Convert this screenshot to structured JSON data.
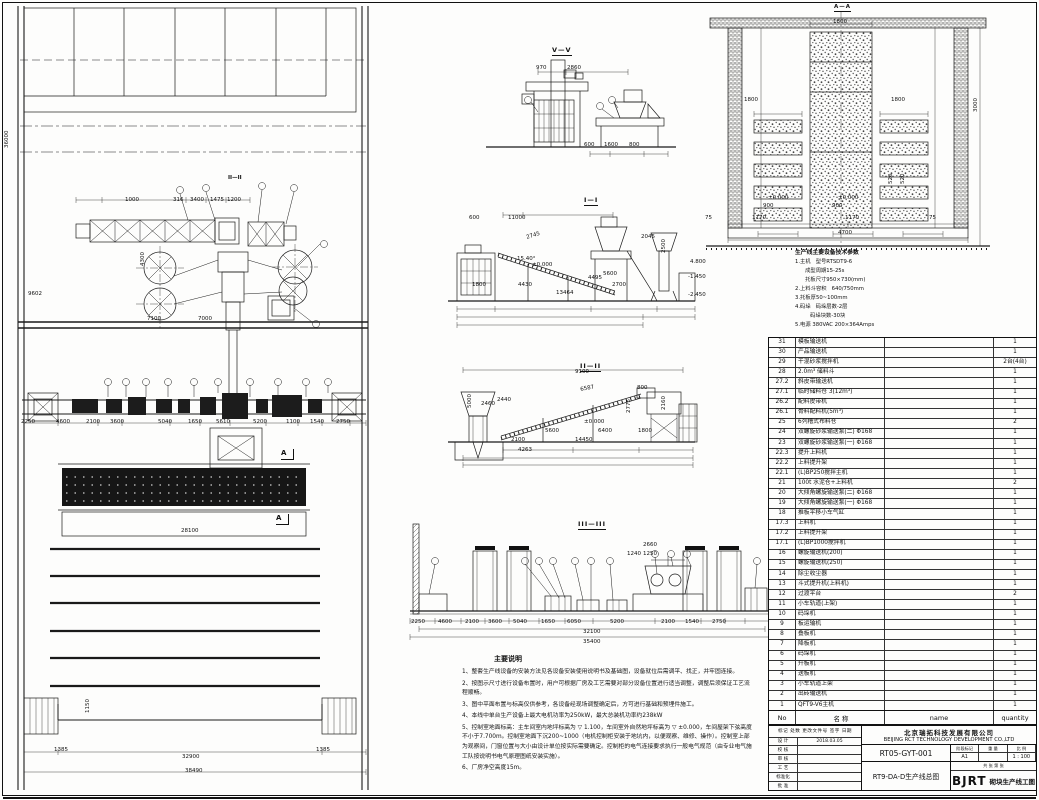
{
  "sections": {
    "s5": "V—V",
    "s1": "I—I",
    "s2": "II—II",
    "s3": "III—III",
    "plan_mark": "II—II",
    "kiln": "A—A",
    "a1": "A",
    "a2": "A"
  },
  "notes": {
    "title": "主要说明",
    "items": [
      {
        "text": "1、整套生产线设备的安装方法见各设备安装使用说明书及基础图，设备就位后需调平、找正，并牢固连接。"
      },
      {
        "text": "2、按图示尺寸进行设备布置时，用户可根据厂房及工艺需要对部分设备位置进行适当调整，调整后须保证工艺流程顺畅。"
      },
      {
        "text": "3、图中平面布置与标高仅供参考，各设备经现场调整确定后，方可进行基础和预埋件施工。"
      },
      {
        "text": "4、本线中单台生产设备上最大电机功率为250kW，最大总装机功率约238kW"
      },
      {
        "text": "5、控制室地面标高：主车间室内地坪标高为 ▽ 1.100，车间室外自然地坪标高为 ▽ ±0.000，车间屋架下弦高度不小于7.700m。控制室地面下沉200~1000（电机控制柜安装于地坑内，以便观察、维修、操作）。控制室上部为观察间，门窗位置与大小由设计单位按实际需要确定。控制柜的电气连接要求执行一般电气规范（由专业电气施工队按说明书电气原理图纸安装实施）。"
      },
      {
        "text": "6、厂房净空高度15m。"
      }
    ]
  },
  "tech_params": {
    "title": "生产线主要设备技术参数",
    "lines": [
      {
        "text": "1.主机   型号RTSDT9-6"
      },
      {
        "text": "      成型周期15-25s"
      },
      {
        "text": "      托板尺寸950×730(mm)"
      },
      {
        "text": "2.上料斗容积   640/750mm"
      },
      {
        "text": "3.托板厚50~100mm"
      },
      {
        "text": "4.码垛   码垛层数-2层"
      },
      {
        "text": "         码垛块数-30块"
      },
      {
        "text": "5.电源 380VAC 200×364Amps"
      }
    ]
  },
  "parts_list": {
    "header": {
      "no": "No",
      "cn": "名        称",
      "en": "name",
      "qty": "quantity"
    },
    "rows": [
      {
        "no": "1",
        "name": "QFT9-V6主机",
        "qty": "1"
      },
      {
        "no": "2",
        "name": "出砖输送机",
        "qty": "1"
      },
      {
        "no": "3",
        "name": "小车轨道上架",
        "qty": "1"
      },
      {
        "no": "4",
        "name": "送板机",
        "qty": "1"
      },
      {
        "no": "5",
        "name": "升板机",
        "qty": "1"
      },
      {
        "no": "6",
        "name": "码垛机",
        "qty": "1"
      },
      {
        "no": "7",
        "name": "降板机",
        "qty": "1"
      },
      {
        "no": "8",
        "name": "叠板机",
        "qty": "1"
      },
      {
        "no": "9",
        "name": "板运输机",
        "qty": "1"
      },
      {
        "no": "10",
        "name": "码垛机",
        "qty": "1"
      },
      {
        "no": "11",
        "name": "小车轨道(上架)",
        "qty": "1"
      },
      {
        "no": "12",
        "name": "过渡平台",
        "qty": "2"
      },
      {
        "no": "13",
        "name": "斗式提升机(上料机)",
        "qty": "1"
      },
      {
        "no": "14",
        "name": "除尘收尘器",
        "qty": "1"
      },
      {
        "no": "15",
        "name": "螺旋输送机(250)",
        "qty": "1"
      },
      {
        "no": "16",
        "name": "螺旋输送机(200)",
        "qty": "1"
      },
      {
        "no": "17.1",
        "name": "(L)BP1000搅拌机",
        "qty": "1"
      },
      {
        "no": "17.2",
        "name": "上料提升架",
        "qty": "1"
      },
      {
        "no": "17.3",
        "name": "上料机",
        "qty": "1"
      },
      {
        "no": "18",
        "name": "推板平移小车气缸",
        "qty": "1"
      },
      {
        "no": "19",
        "name": "大倾角螺旋输送泵(一) Φ168",
        "qty": "1"
      },
      {
        "no": "20",
        "name": "大倾角螺旋输送泵(二) Φ168",
        "qty": "1"
      },
      {
        "no": "21",
        "name": "100t 水泥仓+上料机",
        "qty": "2"
      },
      {
        "no": "22.1",
        "name": "(L)BP250搅拌主机",
        "qty": "1"
      },
      {
        "no": "22.2",
        "name": "上料提升架",
        "qty": "1"
      },
      {
        "no": "22.3",
        "name": "提升上料机",
        "qty": "1"
      },
      {
        "no": "23",
        "name": "双螺旋砂浆输送泵(一) Φ168",
        "qty": "1"
      },
      {
        "no": "24",
        "name": "双螺旋砂浆输送泵(二) Φ168",
        "qty": "1"
      },
      {
        "no": "25",
        "name": "6列槽式布料仓",
        "qty": "2"
      },
      {
        "no": "26.1",
        "name": "骨料配料机(5m³)",
        "qty": "1"
      },
      {
        "no": "26.2",
        "name": "配料皮带机",
        "qty": "1"
      },
      {
        "no": "27.1",
        "name": "临时储料仓 3(12m³)",
        "qty": "1"
      },
      {
        "no": "27.2",
        "name": "斜皮带输送机",
        "qty": "1"
      },
      {
        "no": "28",
        "name": "2.0m³ 储料斗",
        "qty": "1"
      },
      {
        "no": "29",
        "name": "干混砂浆搅拌机",
        "qty": "2台(4台)"
      },
      {
        "no": "30",
        "name": "产品输送机",
        "qty": "1"
      },
      {
        "no": "31",
        "name": "模板输送机",
        "qty": "1"
      }
    ]
  },
  "title_block": {
    "company_cn": "北京瑞拓科技发展有限公司",
    "company_en": "BEIJING RCT TECHNOLOGY DEVELOPMENT CO.,LTD",
    "drawing_no": "RT05-GYT-001",
    "date": "2018.03.05",
    "drawing_title": "RT9-DA-D生产线总图",
    "sheet_size": "A1",
    "scale": "1 : 100",
    "logo": "BJRT",
    "project": "砌块生产线工图",
    "stage_label": "阶段标记",
    "weight_label": "重 量",
    "scale_label": "比 例",
    "sheets": "共  张   第  张",
    "rev_header_line": "标记 处数 更改文件号 签字 日期",
    "rev_rows": [
      {
        "label": "设 计",
        "val": "2018.03.05"
      },
      {
        "label": "校 核",
        "val": ""
      },
      {
        "label": "审 核",
        "val": ""
      },
      {
        "label": "工 艺",
        "val": ""
      },
      {
        "label": "标准化",
        "val": ""
      },
      {
        "label": "批 准",
        "val": ""
      }
    ]
  },
  "dim_labels": [
    {
      "t": "1800",
      "x": 833,
      "y": 20
    },
    {
      "t": "1800",
      "x": 744,
      "y": 98
    },
    {
      "t": "1800",
      "x": 891,
      "y": 98
    },
    {
      "t": "±0.000",
      "x": 768,
      "y": 196
    },
    {
      "t": "±0.000",
      "x": 838,
      "y": 196
    },
    {
      "t": "900",
      "x": 763,
      "y": 204
    },
    {
      "t": "900",
      "x": 832,
      "y": 204
    },
    {
      "t": "520",
      "x": 889,
      "y": 184,
      "r": -90
    },
    {
      "t": "520",
      "x": 901,
      "y": 184,
      "r": -90
    },
    {
      "t": "75",
      "x": 705,
      "y": 216
    },
    {
      "t": "1170",
      "x": 752,
      "y": 216
    },
    {
      "t": "1170",
      "x": 845,
      "y": 216
    },
    {
      "t": "75",
      "x": 929,
      "y": 216
    },
    {
      "t": "4700",
      "x": 838,
      "y": 231
    },
    {
      "t": "3000",
      "x": 974,
      "y": 112,
      "r": -90
    },
    {
      "t": "970",
      "x": 536,
      "y": 66
    },
    {
      "t": "2860",
      "x": 567,
      "y": 66
    },
    {
      "t": "600",
      "x": 584,
      "y": 143
    },
    {
      "t": "1600",
      "x": 604,
      "y": 143
    },
    {
      "t": "800",
      "x": 629,
      "y": 143
    },
    {
      "t": "600",
      "x": 469,
      "y": 216
    },
    {
      "t": "11000",
      "x": 508,
      "y": 216
    },
    {
      "t": "2745",
      "x": 526,
      "y": 236,
      "r": -17
    },
    {
      "t": "15.40°",
      "x": 517,
      "y": 257
    },
    {
      "t": "±0.000",
      "x": 532,
      "y": 263
    },
    {
      "t": "1800",
      "x": 472,
      "y": 283
    },
    {
      "t": "4430",
      "x": 518,
      "y": 283
    },
    {
      "t": "4495",
      "x": 588,
      "y": 276
    },
    {
      "t": "5600",
      "x": 603,
      "y": 272
    },
    {
      "t": "2700",
      "x": 612,
      "y": 283
    },
    {
      "t": "13464",
      "x": 556,
      "y": 291
    },
    {
      "t": "2045",
      "x": 641,
      "y": 235
    },
    {
      "t": "2500",
      "x": 662,
      "y": 253,
      "r": -90
    },
    {
      "t": "4.800",
      "x": 690,
      "y": 260
    },
    {
      "t": "-1.450",
      "x": 688,
      "y": 275
    },
    {
      "t": "-2.450",
      "x": 688,
      "y": 293
    },
    {
      "t": "9100",
      "x": 575,
      "y": 370
    },
    {
      "t": "6587",
      "x": 580,
      "y": 388,
      "r": -11
    },
    {
      "t": "800",
      "x": 637,
      "y": 386
    },
    {
      "t": "2460",
      "x": 481,
      "y": 402
    },
    {
      "t": "2440",
      "x": 497,
      "y": 398
    },
    {
      "t": "5000",
      "x": 468,
      "y": 408,
      "r": -90
    },
    {
      "t": "±0.000",
      "x": 584,
      "y": 420
    },
    {
      "t": "2100",
      "x": 511,
      "y": 438
    },
    {
      "t": "4263",
      "x": 518,
      "y": 448
    },
    {
      "t": "5600",
      "x": 545,
      "y": 429
    },
    {
      "t": "6400",
      "x": 598,
      "y": 429
    },
    {
      "t": "14450",
      "x": 575,
      "y": 438
    },
    {
      "t": "1800",
      "x": 638,
      "y": 429
    },
    {
      "t": "2775",
      "x": 627,
      "y": 413,
      "r": -90
    },
    {
      "t": "2160",
      "x": 662,
      "y": 410,
      "r": -90
    },
    {
      "t": "2250",
      "x": 411,
      "y": 620
    },
    {
      "t": "4600",
      "x": 438,
      "y": 620
    },
    {
      "t": "2100",
      "x": 465,
      "y": 620
    },
    {
      "t": "3600",
      "x": 488,
      "y": 620
    },
    {
      "t": "5040",
      "x": 513,
      "y": 620
    },
    {
      "t": "1650",
      "x": 541,
      "y": 620
    },
    {
      "t": "6050",
      "x": 567,
      "y": 620
    },
    {
      "t": "5200",
      "x": 610,
      "y": 620
    },
    {
      "t": "2100",
      "x": 661,
      "y": 620
    },
    {
      "t": "1540",
      "x": 685,
      "y": 620
    },
    {
      "t": "2750",
      "x": 712,
      "y": 620
    },
    {
      "t": "32100",
      "x": 583,
      "y": 630
    },
    {
      "t": "35400",
      "x": 583,
      "y": 640
    },
    {
      "t": "2660",
      "x": 643,
      "y": 543
    },
    {
      "t": "1240",
      "x": 627,
      "y": 552
    },
    {
      "t": "1250",
      "x": 643,
      "y": 552
    },
    {
      "t": "1000",
      "x": 125,
      "y": 198
    },
    {
      "t": "316",
      "x": 173,
      "y": 198
    },
    {
      "t": "3400",
      "x": 190,
      "y": 198
    },
    {
      "t": "1475",
      "x": 210,
      "y": 198
    },
    {
      "t": "1200",
      "x": 227,
      "y": 198
    },
    {
      "t": "7100",
      "x": 147,
      "y": 317
    },
    {
      "t": "7000",
      "x": 198,
      "y": 317
    },
    {
      "t": "4300",
      "x": 141,
      "y": 266,
      "r": -90
    },
    {
      "t": "9602",
      "x": 28,
      "y": 292
    },
    {
      "t": "36000",
      "x": 5,
      "y": 148,
      "r": -90
    },
    {
      "t": "2250",
      "x": 21,
      "y": 420
    },
    {
      "t": "4600",
      "x": 56,
      "y": 420
    },
    {
      "t": "2100",
      "x": 86,
      "y": 420
    },
    {
      "t": "3600",
      "x": 110,
      "y": 420
    },
    {
      "t": "5040",
      "x": 158,
      "y": 420
    },
    {
      "t": "1650",
      "x": 188,
      "y": 420
    },
    {
      "t": "5610",
      "x": 216,
      "y": 420
    },
    {
      "t": "5200",
      "x": 253,
      "y": 420
    },
    {
      "t": "1100",
      "x": 286,
      "y": 420
    },
    {
      "t": "1540",
      "x": 310,
      "y": 420
    },
    {
      "t": "2750",
      "x": 336,
      "y": 420
    },
    {
      "t": "28100",
      "x": 181,
      "y": 529
    },
    {
      "t": "1150",
      "x": 86,
      "y": 713,
      "r": -90
    },
    {
      "t": "1385",
      "x": 54,
      "y": 748
    },
    {
      "t": "32900",
      "x": 182,
      "y": 755
    },
    {
      "t": "1385",
      "x": 316,
      "y": 748
    },
    {
      "t": "38490",
      "x": 185,
      "y": 769
    }
  ]
}
